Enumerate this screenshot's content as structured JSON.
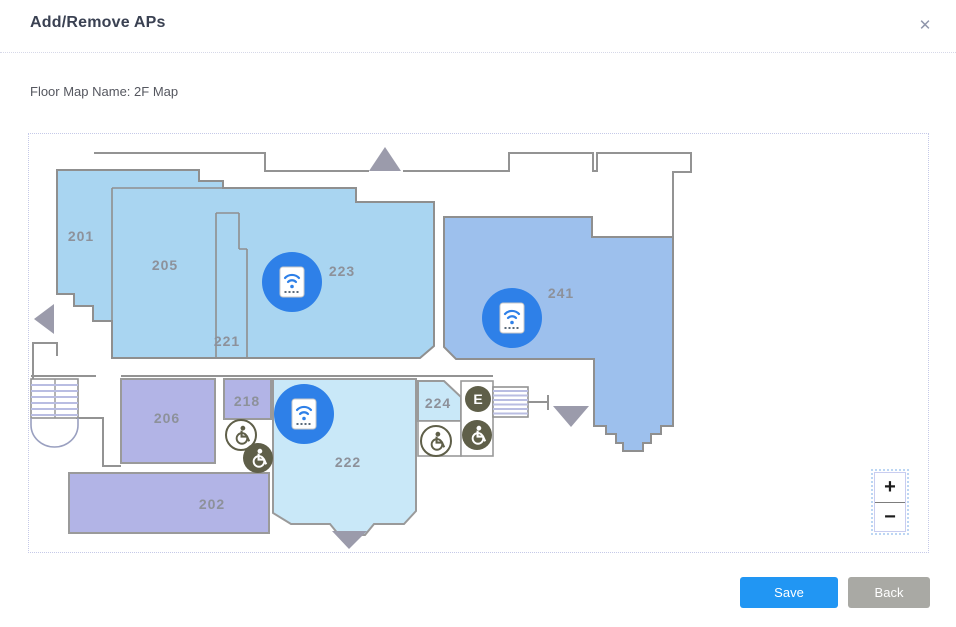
{
  "dialog": {
    "title": "Add/Remove APs",
    "close_label": "✕",
    "floor_map_name_label": "Floor Map Name: 2F Map"
  },
  "map": {
    "rooms": [
      {
        "label": "201"
      },
      {
        "label": "205"
      },
      {
        "label": "221"
      },
      {
        "label": "223"
      },
      {
        "label": "241"
      },
      {
        "label": "206"
      },
      {
        "label": "218"
      },
      {
        "label": "224"
      },
      {
        "label": "222"
      },
      {
        "label": "202"
      }
    ],
    "access_points": {
      "count": 3
    },
    "elevator_label": "E",
    "zoom_in_label": "+",
    "zoom_out_label": "−"
  },
  "footer": {
    "save_label": "Save",
    "back_label": "Back"
  },
  "colors": {
    "room_blue": "#a9d5f1",
    "room_periwinkle": "#9dc0ed",
    "room_cyan": "#c9e8f8",
    "room_lavender": "#b2b4e6",
    "ap_blue": "#2e80e8",
    "icon_olive": "#5f5f49",
    "wall_gray": "#939393",
    "arrow_gray": "#9b9bab",
    "accent_blue": "#2196f3"
  }
}
